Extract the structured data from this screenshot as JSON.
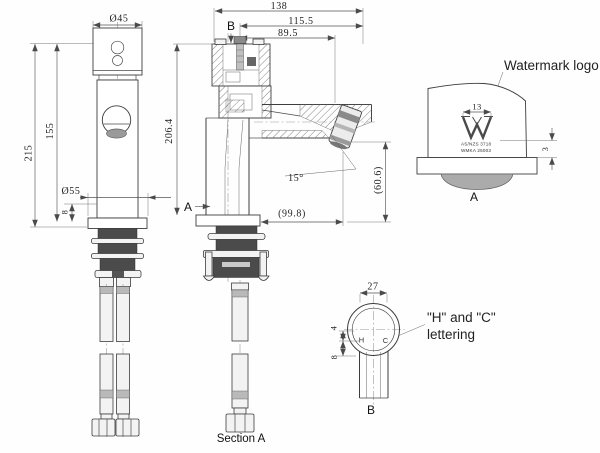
{
  "drawing": {
    "front_view": {
      "dim_dia_top": "Ø45",
      "dim_height_total": "215",
      "dim_height_body": "155",
      "dim_dia_base": "Ø55",
      "dim_base_thickness": "8"
    },
    "section_view": {
      "cut_marker_b": "B",
      "cut_marker_a": "A",
      "dim_width_total": "138",
      "dim_width_mid": "115.5",
      "dim_width_spout": "89.5",
      "dim_height": "206.4",
      "dim_angle": "15°",
      "dim_reach": "(99.8)",
      "dim_outlet_height": "(60.6)",
      "caption": "Section A"
    },
    "detail_a": {
      "callout": "Watermark logo",
      "dim_logo_width": "13",
      "dim_logo_depth": "3",
      "logo_text_line1": "AS/NZS 3718",
      "logo_text_line2": "WMKA 25003",
      "label": "A"
    },
    "detail_b": {
      "callout_line1": "\"H\" and \"C\"",
      "callout_line2": "lettering",
      "dim_outer": "27",
      "dim_letter_offset": "4",
      "dim_letter_height": "8",
      "letter_hot": "H",
      "letter_cold": "C",
      "label": "B"
    },
    "colors": {
      "line": "#3d3d3d",
      "dimension": "#555555",
      "dark_fill": "#4b4b4b",
      "mid_gray": "#b9b9b9",
      "background": "#fefefe"
    }
  }
}
